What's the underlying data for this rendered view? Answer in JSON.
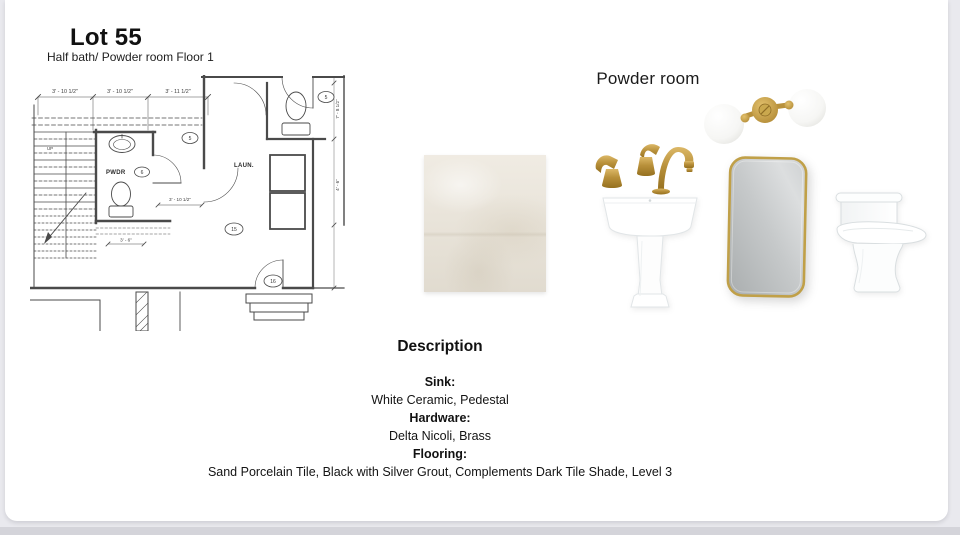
{
  "page": {
    "background_color": "#e9e9ee",
    "card_color": "#ffffff",
    "bottom_strip_color": "#d4d4da"
  },
  "header": {
    "title": "Lot 55",
    "subtitle": "Half bath/ Powder room Floor 1"
  },
  "floor_plan": {
    "dims_top": [
      "3' - 10 1/2\"",
      "3' - 10 1/2\"",
      "3' - 11 1/2\""
    ],
    "dim_mid": "3' - 10 1/2\"",
    "dim_small": "3' - 6\"",
    "side_dims": [
      "7' - 8 1/2\"",
      "4' - 6\""
    ],
    "rooms": {
      "powder": "PWDR",
      "laundry": "LAUN."
    },
    "stairs_label": "UP",
    "keynotes": [
      "5",
      "5",
      "6",
      "15",
      "16"
    ]
  },
  "board": {
    "heading": "Powder room",
    "products": [
      {
        "name": "tile-swatch",
        "label": "sand-porcelain-tile-sample",
        "color": "#eae4d8"
      },
      {
        "name": "faucet",
        "label": "brass-widespread-faucet",
        "color": "#b8903a"
      },
      {
        "name": "pedestal-sink",
        "label": "white-pedestal-sink"
      },
      {
        "name": "sconce",
        "label": "brass-double-globe-sconce"
      },
      {
        "name": "mirror",
        "label": "gold-framed-mirror",
        "frame_color": "#c0a048"
      },
      {
        "name": "toilet",
        "label": "white-one-piece-toilet"
      }
    ]
  },
  "description": {
    "heading": "Description",
    "items": [
      {
        "label": "Sink:",
        "value": "White Ceramic, Pedestal"
      },
      {
        "label": "Hardware:",
        "value": "Delta Nicoli, Brass"
      },
      {
        "label": "Flooring:",
        "value": "Sand Porcelain Tile, Black with Silver Grout, Complements Dark Tile Shade, Level 3"
      }
    ]
  }
}
